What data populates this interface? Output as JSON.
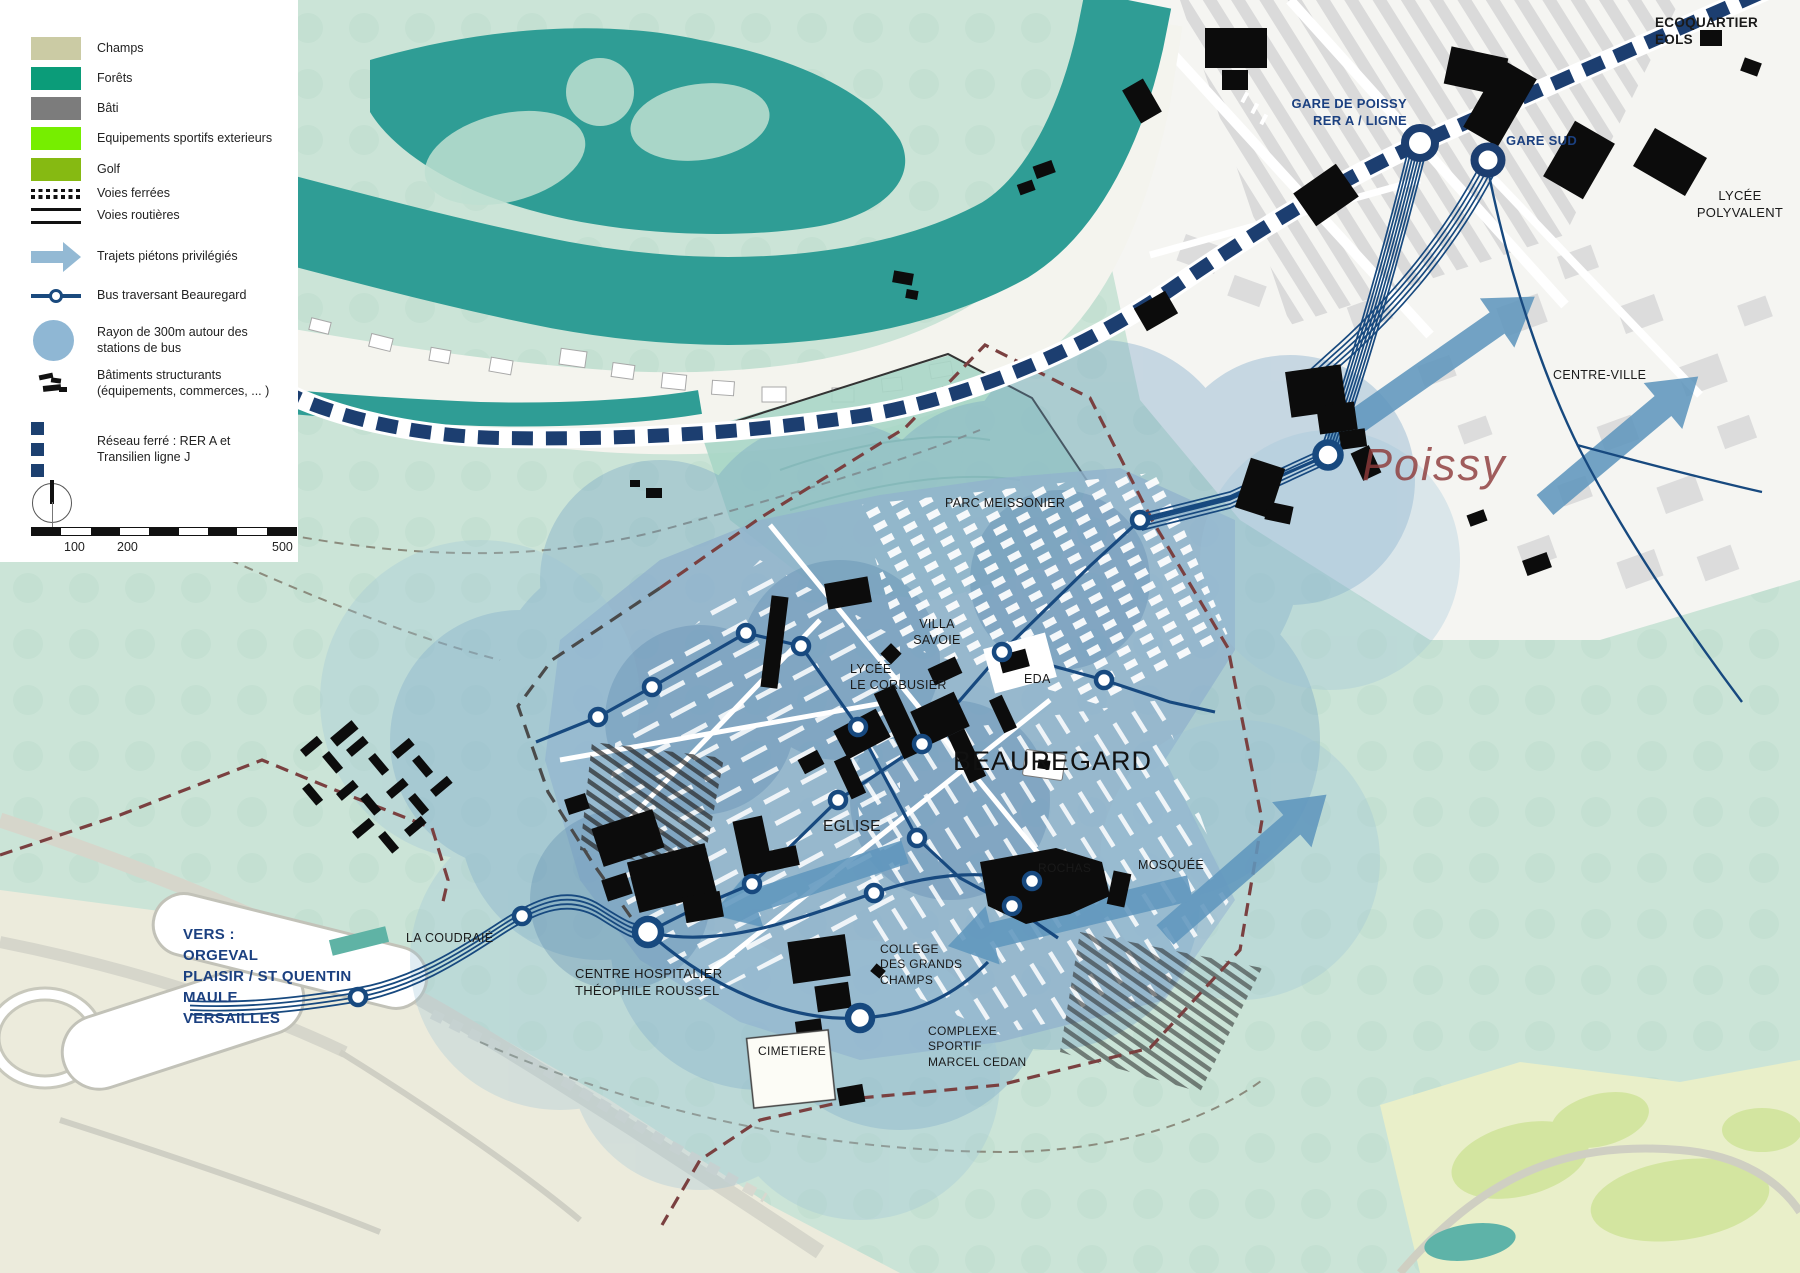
{
  "legend": {
    "items": [
      {
        "label": "Champs",
        "color": "#cbcba4"
      },
      {
        "label": "Forêts",
        "color": "#0b9c79"
      },
      {
        "label": "Bâti",
        "color": "#7c7c7c"
      },
      {
        "label": "Equipements sportifs exterieurs",
        "color": "#76ee00"
      },
      {
        "label": "Golf",
        "color": "#86ba12"
      },
      {
        "label": "Voies ferrées"
      },
      {
        "label": "Voies routières"
      },
      {
        "label": "Trajets piétons privilégiés",
        "color": "#93b9d4"
      },
      {
        "label": "Bus traversant Beauregard",
        "color": "#1a4a7e"
      },
      {
        "label": "Rayon de 300m autour des stations de bus",
        "color": "#8fb7d4"
      },
      {
        "label": "Bâtiments structurants (équipements, commerces, ... )"
      },
      {
        "label": "Réseau ferré : RER A et Transilien ligne J",
        "color": "#1c4070"
      }
    ],
    "scale": {
      "t100": "100",
      "t200": "200",
      "t500": "500"
    }
  },
  "map_labels": {
    "gare_de_poissy": "GARE DE POISSY\nRER A / LIGNE",
    "gare_sud": "GARE SUD",
    "ecoquartier": "ECOQUARTIER\nEOLS",
    "lycee_polyvalent": "LYCÉE\nPOLYVALENT",
    "centre_ville": "CENTRE-VILLE",
    "poissy": "Poissy",
    "parc_meissonier": "PARC MEISSONIER",
    "villa_savoie": "VILLA\nSAVOIE",
    "lycee_corbusier": "LYCÉE\nLE CORBUSIER",
    "eda": "EDA",
    "beauregard": "BEAUREGARD",
    "eglise": "EGLISE",
    "mosquee": "MOSQUÉE",
    "la_coudraie": "LA COUDRAIÉ",
    "centre_hospitalier": "CENTRE HOSPITALIER\nTHÉOPHILE ROUSSEL",
    "college": "COLLEGE\nDES GRANDS\nCHAMPS",
    "rochas": "ROCHAS",
    "complexe_sportif": "COMPLEXE\nSPORTIF\nMARCEL CEDAN",
    "cimetiere": "CIMETIERE",
    "vers": "VERS :\nORGEVAL\nPLAISIR / ST QUENTIN\nMAULE\nVERSAILLES"
  },
  "colors": {
    "river": "#2f9d95",
    "mint": "#cbe4d7",
    "rail_navy": "#1c3e70",
    "bus_navy": "#17497f",
    "radius_blue": "#6f9fc4",
    "arrow_blue": "#6097bd",
    "boundary_brown": "#7a4040"
  }
}
